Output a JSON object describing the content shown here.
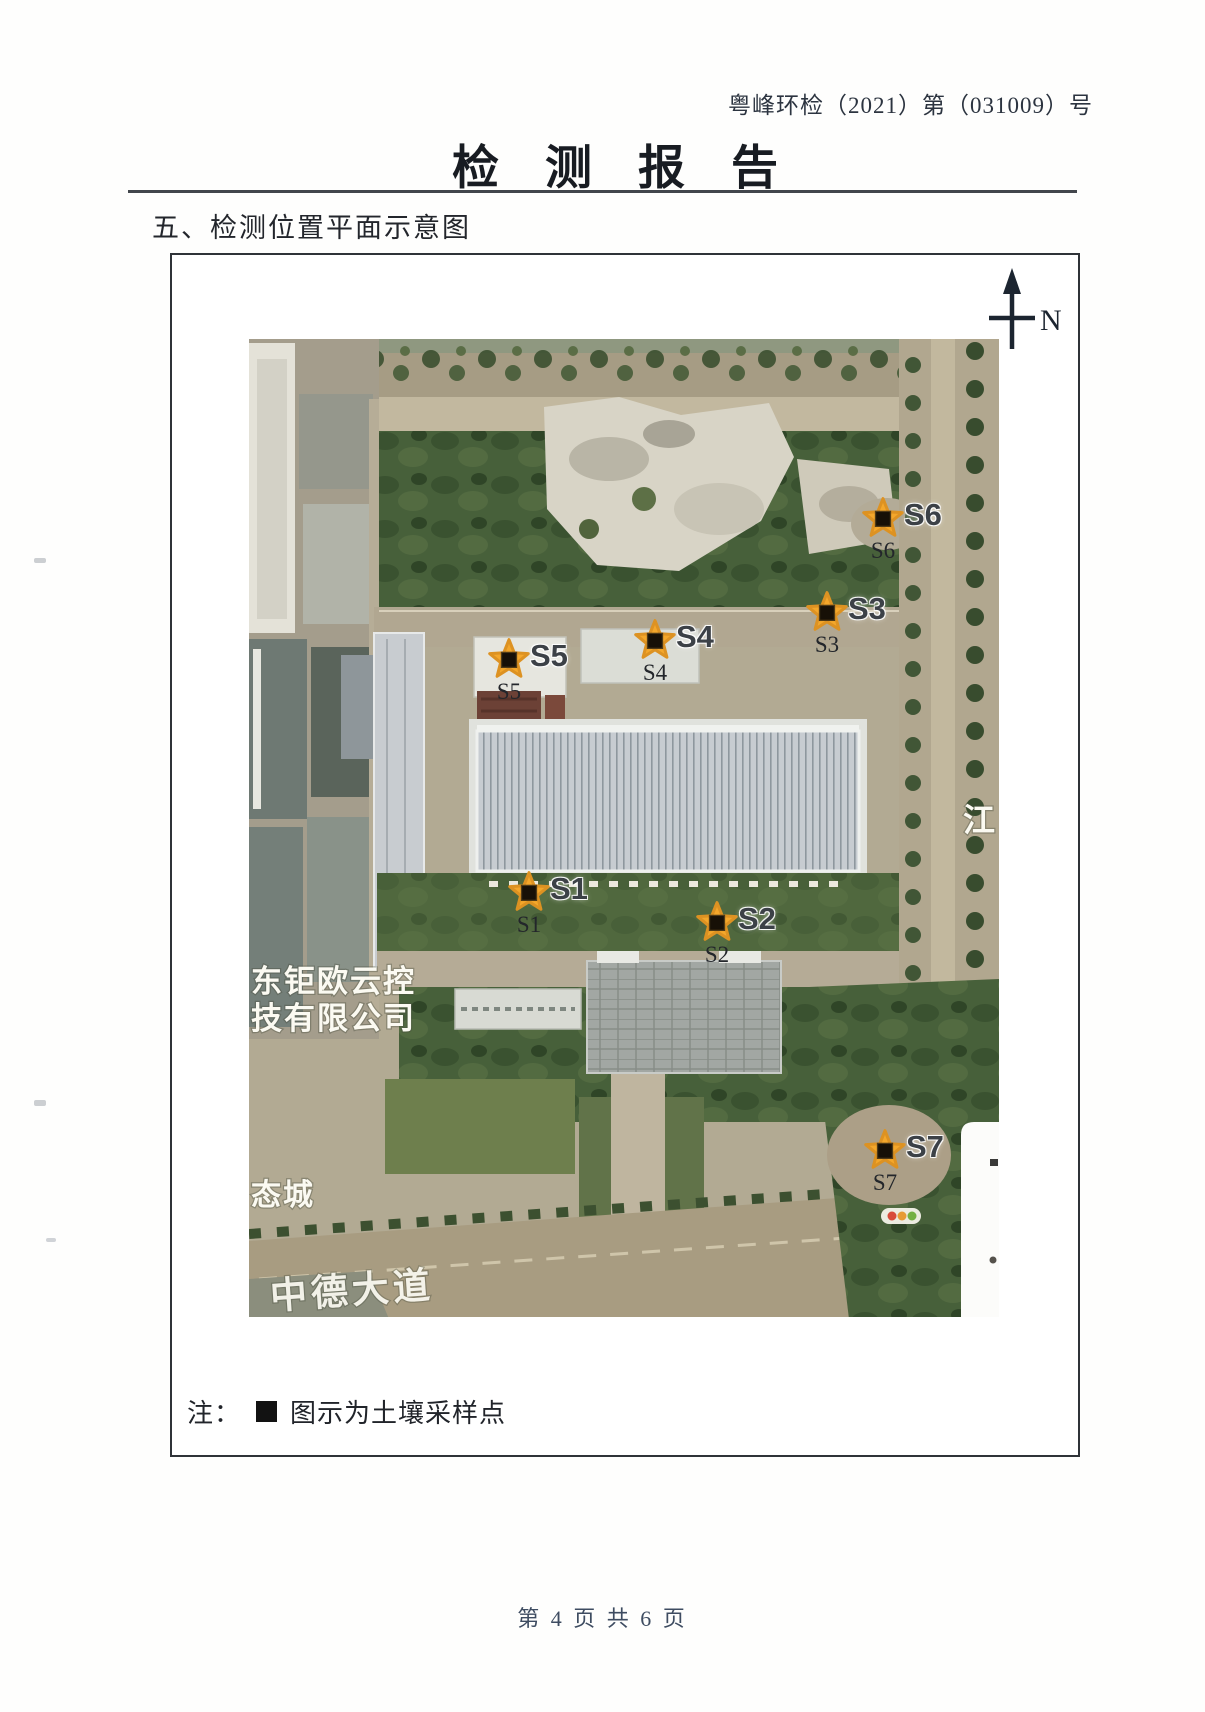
{
  "page": {
    "doc_number": "粤峰环检（2021）第（031009）号",
    "title": "检测报告",
    "section_heading": "五、检测位置平面示意图",
    "footer": "第 4 页 共 6 页"
  },
  "compass": {
    "label": "N"
  },
  "map": {
    "labels": {
      "company_line1": "东钜欧云控",
      "company_line2": "技有限公司",
      "eco_city": "态城",
      "river": "江",
      "road": "中德大道"
    },
    "points": [
      {
        "id": "S1"
      },
      {
        "id": "S2"
      },
      {
        "id": "S3"
      },
      {
        "id": "S4"
      },
      {
        "id": "S5"
      },
      {
        "id": "S6"
      },
      {
        "id": "S7"
      }
    ],
    "marker": {
      "star_color": "#f4a72b",
      "star_edge": "#dd9222",
      "square_color": "#171007"
    }
  },
  "note": {
    "prefix": "注：",
    "text": "图示为土壤采样点"
  }
}
